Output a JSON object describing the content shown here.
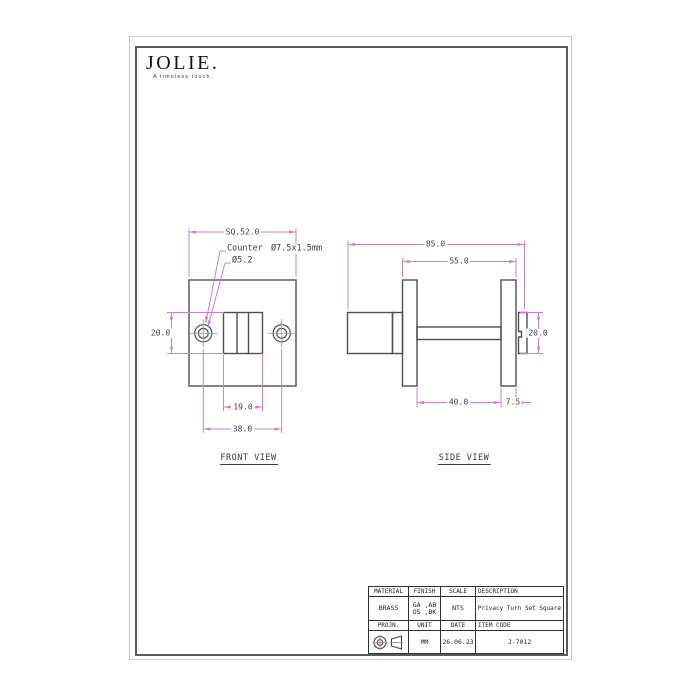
{
  "sheet": {
    "logo": {
      "brand": "JOLIE.",
      "tagline": "A timeless touch."
    }
  },
  "front_view": {
    "label": "FRONT VIEW",
    "dim_square": "SQ.52.0",
    "note_counter": "Counter Ø7.5x1.5mm",
    "note_hole_dia": "Ø5.2",
    "dim_height": "20.0",
    "dim_knob_width": "19.0",
    "dim_hole_spacing": "38.0"
  },
  "side_view": {
    "label": "SIDE VIEW",
    "dim_overall": "85.0",
    "dim_span": "55.0",
    "dim_turn_height": "20.0",
    "dim_spindle": "40.0",
    "dim_plate_thk": "7.5"
  },
  "title_block": {
    "h_material": "MATERIAL",
    "h_finish": "FINISH",
    "h_scale": "SCALE",
    "h_description": "DESCRIPTION",
    "material": "BRASS",
    "finish_1": "GA ,AB",
    "finish_2": "OS ,BK",
    "scale": "NTS",
    "description": "Privacy Turn Set Square",
    "h_projn": "PROJN.",
    "h_unit": "UNIT",
    "h_date": "DATE",
    "h_item": "ITEM CODE",
    "unit": "MM",
    "date": "26.06.23",
    "item_code": "J-7012"
  },
  "colors": {
    "dimension_pink": "#cf7fcf",
    "outline_gray": "#4f4f4f",
    "centerline_gray": "#9e9e9e"
  }
}
